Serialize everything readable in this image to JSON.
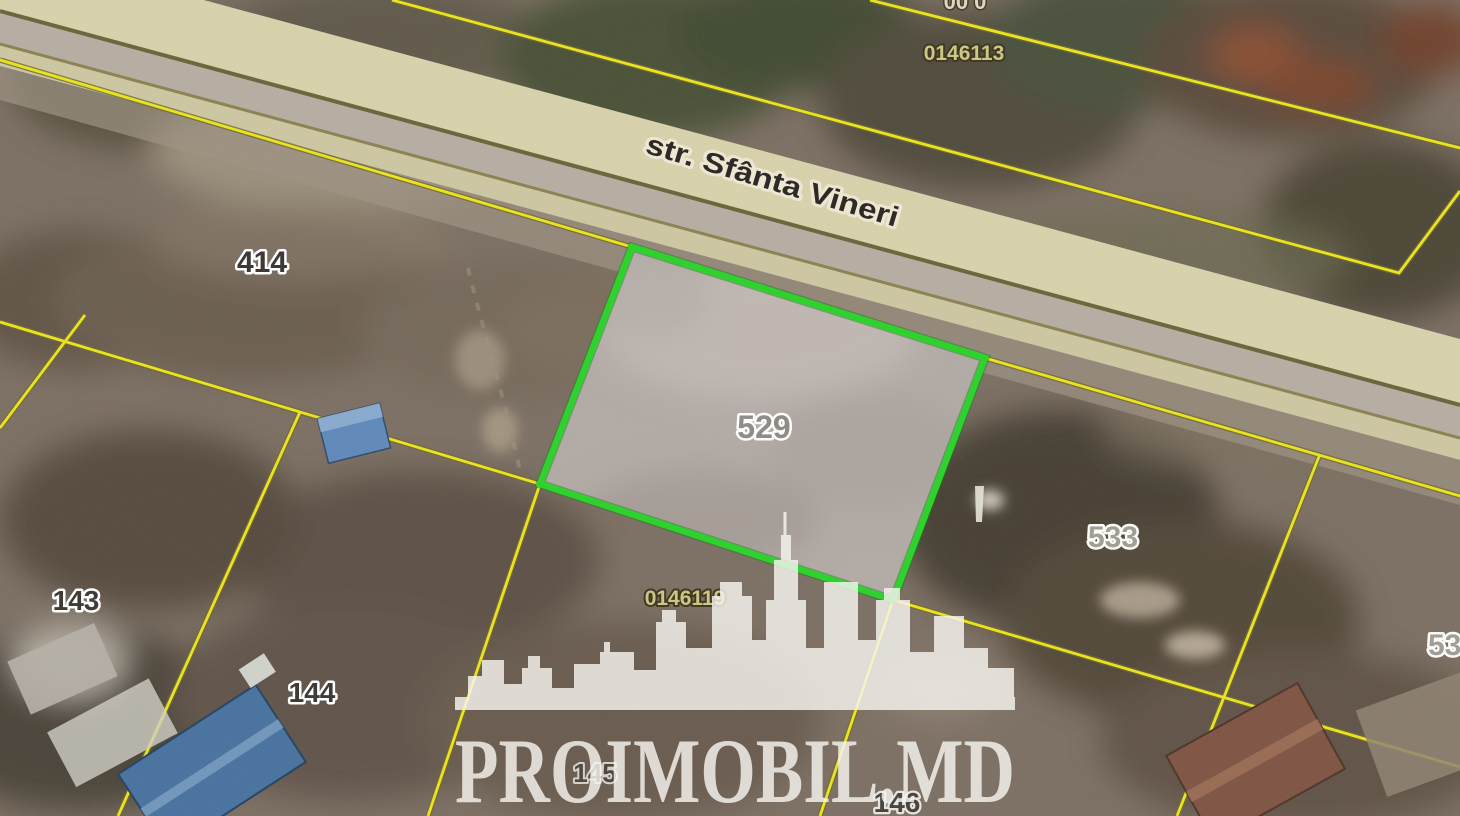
{
  "map_image": {
    "street": {
      "label": "str. Sfânta Vineri"
    },
    "highlighted_parcel": {
      "number": "529",
      "outline_color": "#27d327",
      "fill_color": "#b2aaa6"
    },
    "parcels": {
      "p414": "414",
      "p533": "533",
      "p143": "143",
      "p144": "144",
      "p145": "145",
      "p146": "146",
      "p53_partial": "53"
    },
    "cadastral_codes": {
      "north": "0146113",
      "south": "0146119",
      "top_partial": "00 0"
    },
    "boundary_color": "#ece51a",
    "road_color": "#d8d3ac"
  },
  "watermark": {
    "brand": "PROIMOBIL.MD",
    "logo": "city-skyline"
  }
}
